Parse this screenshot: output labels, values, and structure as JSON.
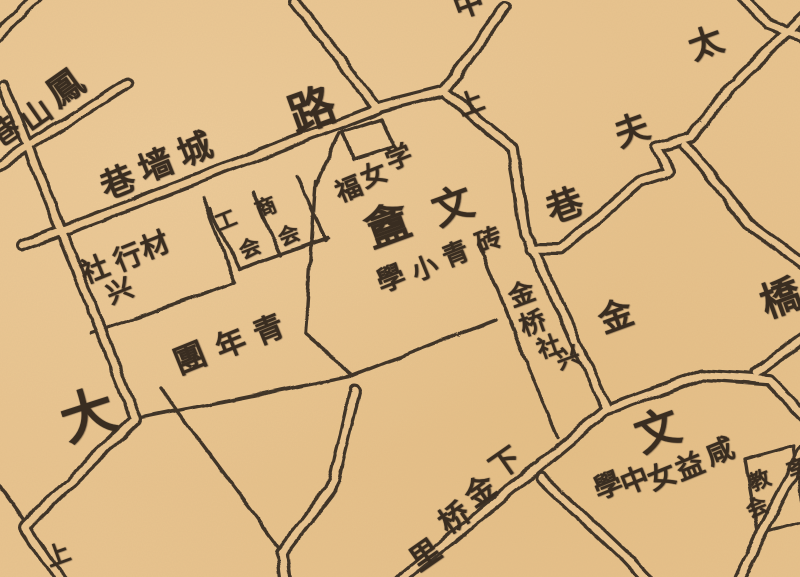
{
  "map": {
    "description": "Scanned historical Chinese city street map, hand-drawn dark ink roads on tan paper",
    "palette": {
      "paper": "#e9c48f",
      "ink": "#3e3126"
    },
    "streets": [
      "鳳山巷",
      "城墙巷",
      "路",
      "中",
      "上",
      "太夫巷",
      "金橋",
      "下金桥里",
      "大",
      "上"
    ],
    "places": [
      "材行社",
      "工会",
      "商会",
      "青年團",
      "福女学",
      "文盦",
      "砖青小學",
      "金桥社",
      "文",
      "咸益女中學",
      "教会"
    ],
    "labels": [
      {
        "text": "鳳",
        "group": "鳳山巷"
      },
      {
        "text": "山",
        "group": "鳳山巷"
      },
      {
        "text": "巷",
        "group": "鳳山巷"
      },
      {
        "text": "城",
        "group": "城墙巷"
      },
      {
        "text": "墙",
        "group": "城墙巷"
      },
      {
        "text": "巷",
        "group": "城墙巷"
      },
      {
        "text": "路",
        "group": "路"
      },
      {
        "text": "中",
        "group": "中"
      },
      {
        "text": "上",
        "group": "上"
      },
      {
        "text": "太",
        "group": "太夫巷"
      },
      {
        "text": "夫",
        "group": "太夫巷"
      },
      {
        "text": "巷",
        "group": "太夫巷"
      },
      {
        "text": "金",
        "group": "金橋"
      },
      {
        "text": "橋",
        "group": "金橋"
      },
      {
        "text": "工",
        "group": "工会"
      },
      {
        "text": "会",
        "group": "工会"
      },
      {
        "text": "商",
        "group": "商会"
      },
      {
        "text": "会",
        "group": "商会"
      },
      {
        "text": "福",
        "group": "福女学"
      },
      {
        "text": "女",
        "group": "福女学"
      },
      {
        "text": "学",
        "group": "福女学"
      },
      {
        "text": "盦",
        "group": "文盦"
      },
      {
        "text": "文",
        "group": "文盦"
      },
      {
        "text": "砖",
        "group": "砖青小學"
      },
      {
        "text": "青",
        "group": "砖青小學"
      },
      {
        "text": "小",
        "group": "砖青小學"
      },
      {
        "text": "學",
        "group": "砖青小學"
      },
      {
        "text": "金",
        "group": "金桥社"
      },
      {
        "text": "桥",
        "group": "金桥社"
      },
      {
        "text": "社",
        "group": "金桥社"
      },
      {
        "text": "兴",
        "group": "金桥社"
      },
      {
        "text": "材",
        "group": "材行社"
      },
      {
        "text": "行",
        "group": "材行社"
      },
      {
        "text": "社",
        "group": "材行社"
      },
      {
        "text": "兴",
        "group": "材行社"
      },
      {
        "text": "青",
        "group": "青年團"
      },
      {
        "text": "年",
        "group": "青年團"
      },
      {
        "text": "團",
        "group": "青年團"
      },
      {
        "text": "大",
        "group": "大"
      },
      {
        "text": "上",
        "group": "上"
      },
      {
        "text": "下",
        "group": "下金桥里"
      },
      {
        "text": "金",
        "group": "下金桥里"
      },
      {
        "text": "桥",
        "group": "下金桥里"
      },
      {
        "text": "里",
        "group": "下金桥里"
      },
      {
        "text": "文",
        "group": "文"
      },
      {
        "text": "咸",
        "group": "咸益女中學"
      },
      {
        "text": "益",
        "group": "咸益女中學"
      },
      {
        "text": "女",
        "group": "咸益女中學"
      },
      {
        "text": "中",
        "group": "咸益女中學"
      },
      {
        "text": "學",
        "group": "咸益女中學"
      },
      {
        "text": "教",
        "group": "教会"
      },
      {
        "text": "会",
        "group": "教会"
      },
      {
        "text": "斈",
        "group": "教会"
      }
    ]
  }
}
